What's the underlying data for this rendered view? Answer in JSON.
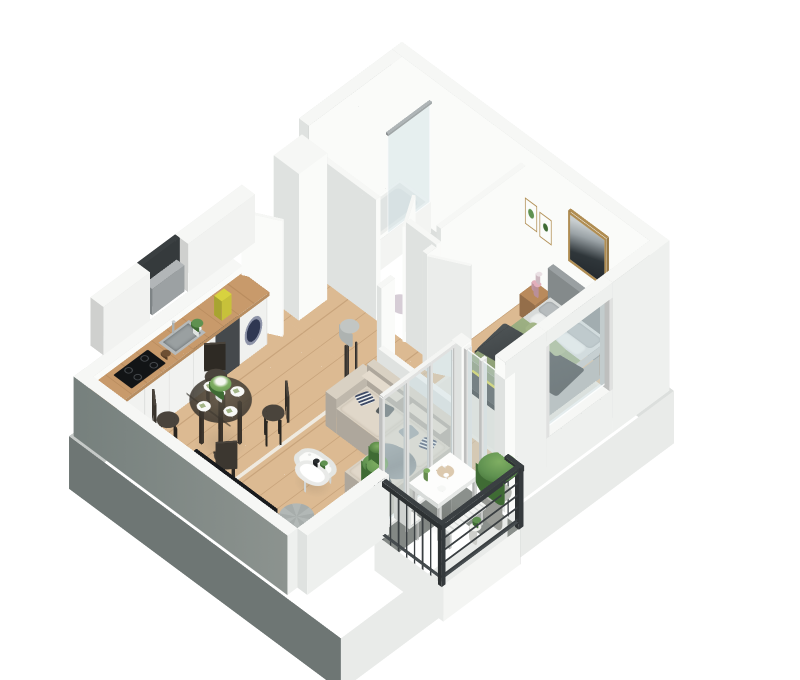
{
  "meta": {
    "type": "3d-isometric-floor-plan",
    "description": "Cutaway 3D isometric floor plan render of a one-bedroom apartment with open kitchen-living room, bathroom, bedroom and balcony on a white background",
    "style": "photorealistic dollhouse render, white cut walls, light wood floors"
  },
  "palette": {
    "wallTop": "#f6f7f5",
    "wallLight": "#fafbf9",
    "wallMid": "#ebedeb",
    "wallShade": "#dfe2e0",
    "extSW": "#76807d",
    "extSWLight": "#8c938f",
    "extNW": "#c6cac8",
    "extNE": "#dcdfdd",
    "extSE": "#eef0ee",
    "plinthDark": "#6e7674",
    "plinthLight": "#e9ebe9",
    "woodFloor": "#dcba92",
    "woodFloorLine": "rgba(150,108,66,0.28)",
    "counterWood": "#c89a6b",
    "furnWood": "#b98a5c",
    "cabinet": "#f1f2f0",
    "darkUnit": "#45494c",
    "steel": "#b6babb",
    "hob": "#121416",
    "washerDoor": "#2f3752",
    "glass": "rgba(203,221,227,0.42)",
    "glassFrame": "#f4f5f3",
    "tile": "#a9b0b2",
    "tileLine": "rgba(66,76,80,0.22)",
    "balconyFloor": "#9aa09c",
    "railing": "#3a3f42",
    "bedHeadboard": "#9aa0a2",
    "mattress": "#d8dbda",
    "duvetSage": "#9db083",
    "blanketCharcoal": "#3e4345",
    "pillowGrey": "#b7bcbe",
    "pillowWhite": "#edefee",
    "cushionSage": "#a3b587",
    "sofa": "#d9d1c3",
    "cushionDark": "#565c5e",
    "cushionNavy": "#3e4a66",
    "throw": "#97a0a3",
    "rugLiving": "#e9e4da",
    "rugBedroom": "#e7e3db",
    "pouf": "#b2b8b6",
    "tableGlass": "rgba(56,51,44,0.85)",
    "green": "#5f9150",
    "greenDark": "#3f6b34",
    "greenLight": "#7fae62",
    "potWhite": "#e8e9e5",
    "potConcrete": "#b9bcb6",
    "pink": "#e2aebb",
    "yellow": "#d8d23f",
    "artDark": "#2f363a",
    "frameWood": "#b08d52",
    "tv": "#191b1d",
    "white": "#ffffff"
  },
  "rooms": [
    {
      "id": "hallway",
      "label": "Hallway",
      "furniture": [
        "entry-door",
        "duct-column"
      ]
    },
    {
      "id": "bathroom",
      "label": "Bathroom",
      "furniture": [
        "bathtub",
        "glass-shower-screen",
        "toilet",
        "bath-mat"
      ]
    },
    {
      "id": "kitchen-dining",
      "label": "Kitchen / Dining",
      "furniture": [
        "kitchen-base-cabinets",
        "wood-countertop",
        "washing-machine",
        "dark-base-unit",
        "sink",
        "induction-hob",
        "upper-cabinets",
        "microwave-niche",
        "yellow-bag",
        "counter-plant",
        "round-glass-dining-table",
        "dining-chairs",
        "place-settings",
        "flower-centerpiece"
      ]
    },
    {
      "id": "living-room",
      "label": "Living Room",
      "furniture": [
        "corner-sofa",
        "scatter-cushions",
        "grey-throw",
        "coffee-table",
        "area-rug",
        "pouf",
        "tv",
        "media-sideboard",
        "tripod-floor-lamp",
        "large-potted-plant",
        "small-floor-plant"
      ]
    },
    {
      "id": "bedroom",
      "label": "Bedroom",
      "furniture": [
        "double-bed",
        "upholstered-headboard",
        "pillows",
        "sage-duvet",
        "charcoal-blanket",
        "nightstand-left",
        "nightstand-right",
        "pink-vases",
        "foot-bench",
        "dresser",
        "wall-art-landscape",
        "botanical-print-1",
        "botanical-print-2",
        "bedroom-rug",
        "window"
      ]
    },
    {
      "id": "balcony",
      "label": "Balcony",
      "furniture": [
        "metal-railing",
        "outdoor-table",
        "slatted-bench",
        "folding-chair",
        "concrete-planter",
        "white-jug",
        "serving-tray"
      ]
    }
  ],
  "counts": {
    "dining_chairs": 4,
    "place_settings": 4,
    "glass_wall_panes": 3,
    "bed_pillow_pairs": 3,
    "hob_rings": 4,
    "botanical_prints": 2
  }
}
